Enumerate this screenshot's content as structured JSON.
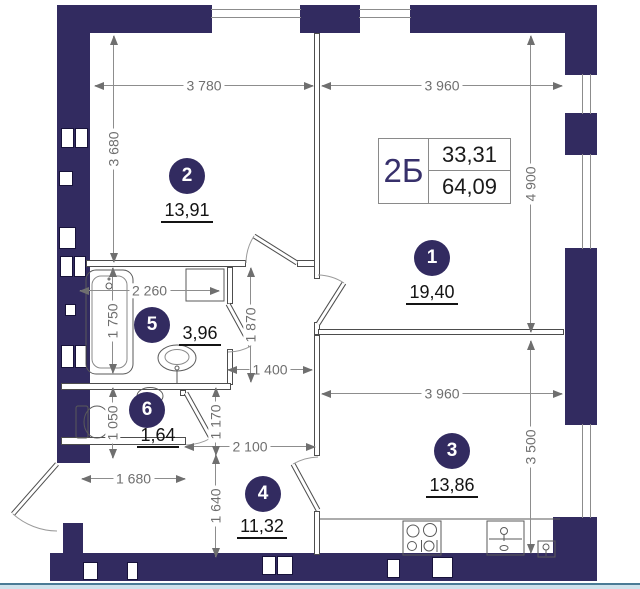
{
  "plan": {
    "unit": {
      "label": "2Б",
      "living_area": "33,31",
      "total_area": "64,09"
    },
    "rooms": [
      {
        "number": "1",
        "area": "19,40"
      },
      {
        "number": "2",
        "area": "13,91"
      },
      {
        "number": "3",
        "area": "13,86"
      },
      {
        "number": "4",
        "area": "11,32"
      },
      {
        "number": "5",
        "area": "3,96"
      },
      {
        "number": "6",
        "area": "1,64"
      }
    ],
    "dims": {
      "room2_width": "3 780",
      "room1_width": "3 960",
      "room2_height": "3 680",
      "room1_height": "4 900",
      "bath_width": "2 260",
      "bath_height": "1 750",
      "hall_upper_height": "1 870",
      "hall_mid_width": "1 400",
      "wc_height": "1 050",
      "hall_mid_height": "1 170",
      "hall_lower_width": "2 100",
      "entry_width": "1 680",
      "hall_lower_height": "1 640",
      "kitchen_width": "3 960",
      "kitchen_height": "3 500"
    },
    "colors": {
      "wall": "#322b60",
      "accent": "#37306b",
      "dim_text": "#6f6f6f",
      "area_text": "#141414",
      "baseline": "#cfe2ec"
    }
  }
}
